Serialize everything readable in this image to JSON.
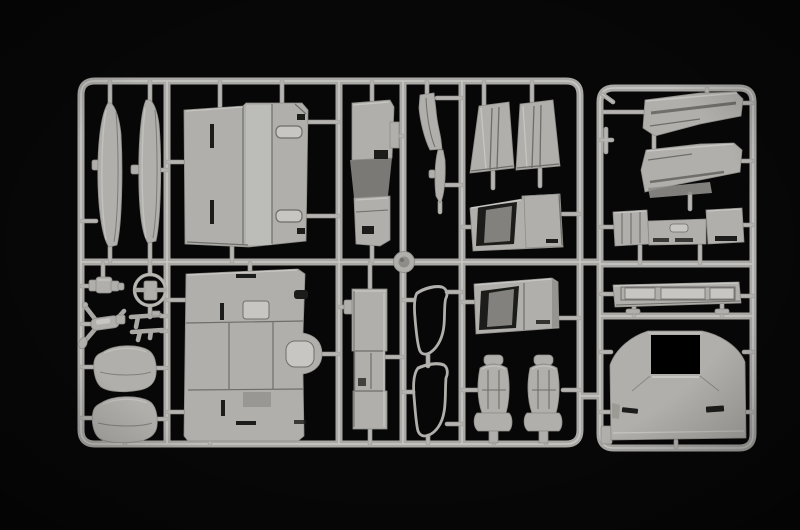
{
  "scene": {
    "description": "Photograph of a light-gray injection-molded plastic model kit sprue (parts tree) for a truck cab, lying on a black background",
    "background": "black",
    "sprue_sections": 2,
    "part_count": 28
  },
  "colors": {
    "background": "#070707",
    "runner": "#a9a8a5",
    "runner_highlight": "#d2d1cd",
    "plastic": "#b0afab",
    "plastic_light": "#c7c6c2",
    "plastic_dark": "#8e8d89",
    "recess": "#1c1c1a",
    "opening": "#000000",
    "line_dark": "#6f6e6b"
  },
  "parts": [
    {
      "id": "sprue-frame",
      "label": "Sprue runner frame"
    },
    {
      "id": "side-skirt-panel-1",
      "label": "Narrow side skirt panel (left)"
    },
    {
      "id": "side-skirt-panel-2",
      "label": "Narrow side skirt panel (right)"
    },
    {
      "id": "cab-rear-wall-panel",
      "label": "Cab rear wall panel with handle recesses"
    },
    {
      "id": "engine-tunnel-module",
      "label": "Engine tunnel / interior module"
    },
    {
      "id": "pillar-bracket",
      "label": "Small pillar bracket"
    },
    {
      "id": "trim-strip",
      "label": "Narrow trim strip"
    },
    {
      "id": "cab-corner-trim-left",
      "label": "Cab corner trim panel (left)"
    },
    {
      "id": "cab-corner-trim-right",
      "label": "Cab corner trim panel (right)"
    },
    {
      "id": "door-step-panel-upper",
      "label": "Door step panel with recess (upper)"
    },
    {
      "id": "roof-deflector-upper",
      "label": "Roof air deflector half (upper)"
    },
    {
      "id": "roof-deflector-lower",
      "label": "Roof air deflector half (lower)"
    },
    {
      "id": "dashboard-grille-panel",
      "label": "Dashboard / grille panel with end boxes"
    },
    {
      "id": "gear-knob-cylinder",
      "label": "Small stepped cylinder part"
    },
    {
      "id": "steering-wheel",
      "label": "Steering wheel"
    },
    {
      "id": "mirror-arm-assembly",
      "label": "Mirror arm assembly"
    },
    {
      "id": "wiper-arms",
      "label": "Wiper arm parts"
    },
    {
      "id": "bunk-mattress-upper",
      "label": "Bunk mattress cushion (upper)"
    },
    {
      "id": "bunk-mattress-lower",
      "label": "Bunk mattress cushion (lower)"
    },
    {
      "id": "cab-floor-panel",
      "label": "Cab floor panel with engine tunnel bulge"
    },
    {
      "id": "bunk-cabinet",
      "label": "Bunk / cabinet box part"
    },
    {
      "id": "window-seal-upper",
      "label": "Door window seal wire part (upper)"
    },
    {
      "id": "window-seal-lower",
      "label": "Door window seal wire part (lower)"
    },
    {
      "id": "round-cap",
      "label": "Round cap on runner junction"
    },
    {
      "id": "door-step-panel-lower",
      "label": "Door step panel with recess (lower)"
    },
    {
      "id": "driver-seat",
      "label": "Truck seat (left)"
    },
    {
      "id": "passenger-seat",
      "label": "Truck seat (right)"
    },
    {
      "id": "front-bumper",
      "label": "Front bumper bar"
    },
    {
      "id": "cab-roof-panel",
      "label": "Cab roof panel with sunroof opening"
    }
  ]
}
